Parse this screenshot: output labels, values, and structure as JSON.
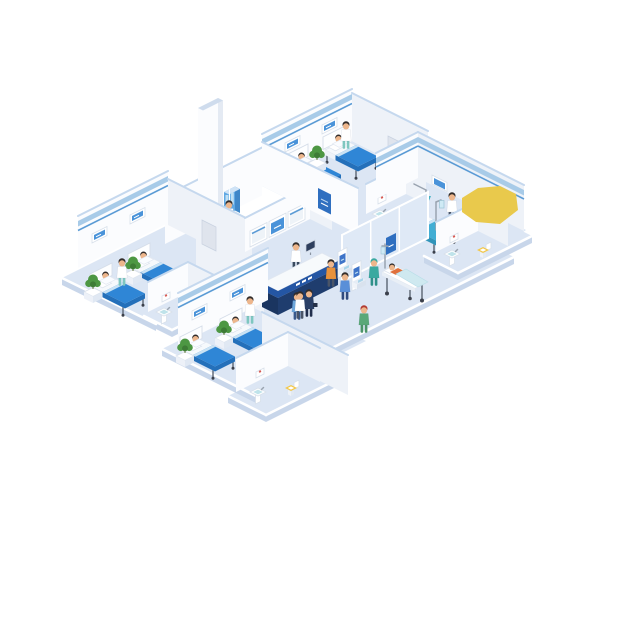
{
  "scene": {
    "subject": "Isometric hospital ward floor illustration",
    "background": "#ffffff"
  },
  "palette": {
    "page_bg": "#ffffff",
    "floor": "#dce6f4",
    "floor_side": "#c8d6ea",
    "wall_white": "#fbfcfe",
    "wall_shade": "#eef2f8",
    "wall_cap": "#c5d8ee",
    "stripe_light": "#a8cbe8",
    "stripe_blue": "#5b9bd5",
    "blanket_blue": "#2f86d6",
    "blanket_blue_dark": "#2470ba",
    "blanket_teal": "#42aed4",
    "blanket_teal_dark": "#3295ba",
    "screen_blue": "#4a93d9",
    "desk_band": "#2456a4",
    "desk_body": "#1f3d6e",
    "plant_green": "#4d9743",
    "plant_green_dark": "#3e7c36",
    "skin": "#edb68c",
    "hair_dark": "#332d2b",
    "scrub_teal": "#3aa9a0",
    "scrub_green": "#5aa878",
    "shirt_orange": "#e8923c",
    "shirt_blue": "#5a8fd8",
    "suit_navy": "#2b4066",
    "accent_yellow": "#e9c94c",
    "kiosk_screen": "#3f74c8",
    "basin_teal": "#bfe3ea",
    "toilet_seat": "#f3c84a",
    "cabinet_blue": "#5fa8e4",
    "gurney_blanket": "#cfe9f0",
    "poster_blue": "#2f6fc0",
    "cross_red": "#d04038"
  },
  "inventory": {
    "wards": [
      {
        "id": "ward-top",
        "beds": 2,
        "patients_in_bed": 2,
        "nurses": 1,
        "wall_monitors": 2,
        "potted_plants": 1
      },
      {
        "id": "ward-left",
        "beds": 2,
        "patients_in_bed": 2,
        "nurses": 1,
        "wall_monitors": 2,
        "potted_plants": 2
      },
      {
        "id": "ward-bottom",
        "beds": 2,
        "patients_in_bed": 2,
        "nurses": 1,
        "wall_monitors": 2,
        "potted_plants": 2
      },
      {
        "id": "ward-right",
        "beds": 1,
        "patients_in_bed": 1,
        "doctors": 1,
        "wall_monitors": 1,
        "potted_plants": 1,
        "extras": [
          "exam-lamp",
          "iv-stand",
          "supply-cart"
        ]
      }
    ],
    "bathrooms": [
      {
        "id": "bathroom-middle",
        "fixtures": [
          "sink",
          "toilet",
          "wall-picture"
        ]
      },
      {
        "id": "bathroom-right",
        "fixtures": [
          "sink",
          "toilet",
          "wall-picture"
        ]
      },
      {
        "id": "bathroom-left",
        "fixtures": [
          "sink",
          "toilet",
          "wall-picture"
        ]
      },
      {
        "id": "bathroom-bottom",
        "fixtures": [
          "sink",
          "toilet",
          "wall-picture"
        ]
      }
    ],
    "lobby": {
      "reception_desk": {
        "receptionists": 1,
        "desk_monitor": 1,
        "sign_band": true
      },
      "info_screens_on_wall": 3,
      "self_service_kiosks": 2,
      "kiosk_users": 2,
      "stretcher": {
        "patients": 1,
        "attendants": 1,
        "iv_pole": 1
      },
      "pedestrians": [
        "blue-scrubs-staff",
        "navy-suit-visitor",
        "green-nurse"
      ],
      "medicine_cabinet": {
        "attendants": 1
      },
      "tall_column": 1,
      "glass_partition": 1,
      "wall_posters": 2,
      "doors": 6
    },
    "decor": [
      "yellow-polygon-shape"
    ]
  }
}
